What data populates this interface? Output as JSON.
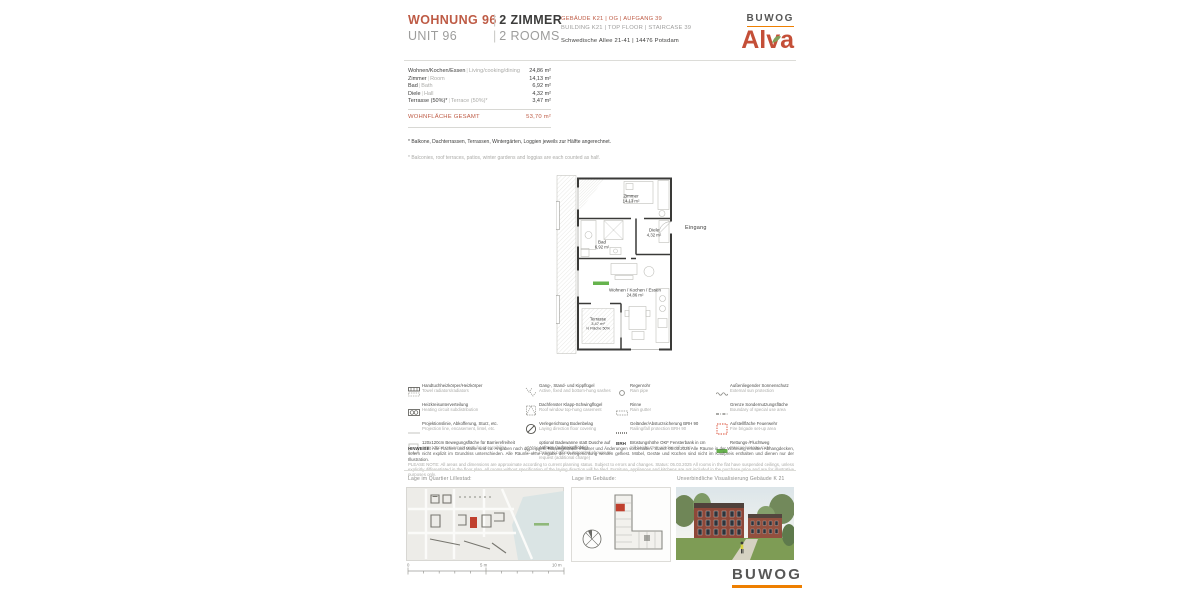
{
  "brand": {
    "buwog": "BUWOG",
    "alva": "Alva"
  },
  "header": {
    "unit_de": "WOHNUNG 96",
    "unit_en": "UNIT 96",
    "rooms_de": "2 ZIMMER",
    "rooms_en": "2 ROOMS",
    "sep": "|",
    "building_de": "GEBÄUDE K21 | OG | AUFGANG 39",
    "building_en": "BUILDING K21 | TOP FLOOR | STAIRCASE 39",
    "address": "Schwedische Allee 21-41 | 14476 Potsdam"
  },
  "area_table": {
    "sep": "|",
    "rows": [
      {
        "de": "Wohnen/Kochen/Essen",
        "en": "Living/cooking/dining",
        "value": "24,86 m²"
      },
      {
        "de": "Zimmer",
        "en": "Room",
        "value": "14,13 m²"
      },
      {
        "de": "Bad",
        "en": "Bath",
        "value": "6,92 m²"
      },
      {
        "de": "Diele",
        "en": "Hall",
        "value": "4,32 m²"
      },
      {
        "de": "Terrasse (50%)*",
        "en": "Terrace (50%)*",
        "value": "3,47 m²"
      }
    ],
    "total_label": "WOHNFLÄCHE GESAMT",
    "total_value": "53,70 m²"
  },
  "footnotes": {
    "de": "* Balkone, Dachterrassen, Terrassen, Wintergärten, Loggien jeweils zur Hälfte angerechnet.",
    "en": "* Balconies, roof terraces, patios, winter gardens and loggias are each counted as half."
  },
  "floor_plan": {
    "rooms": [
      {
        "name": "Zimmer",
        "area": "14,13 m²"
      },
      {
        "name": "Diele",
        "area": "4,32 m²"
      },
      {
        "name": "Bad",
        "area": "6,92 m²"
      },
      {
        "name": "Wohnen / Kochen / Essen",
        "area": "24,86 m²"
      },
      {
        "name": "Terrasse",
        "area": "3,47 m²",
        "note": "½ Fläche 50%"
      }
    ],
    "entrance_label": "Eingang"
  },
  "legend": {
    "items": [
      {
        "de": "Handtuchheizkörper/Heizkörper",
        "en": "Towel radiators/radiators"
      },
      {
        "de": "Heizkreisunterverteilung",
        "en": "Heating circuit subdistribution"
      },
      {
        "de": "Projektionslinie, Abkofferung, Sturz, etc.",
        "en": "Projection line, encasement, lintel, etc."
      },
      {
        "de": "120x120cm Bewegungsfläche für Barrierefreiheit",
        "en": "120x120cm movement area for accessibility"
      },
      {
        "de": "Gang-, Stand- und Kippflügel",
        "en": "Active, fixed and bottom-hung sashes"
      },
      {
        "de": "Dachfenster Klapp-Schwingflügel",
        "en": "Roof window top-hung casement"
      },
      {
        "de": "Verlegerichtung Bodenbelag",
        "en": "Laying direction floor covering"
      },
      {
        "de": "optional Badewanne statt Dusche auf Anfrage (aufpreispflichtig)",
        "en": "Optional bathtub instead of shower on request (additional charge)"
      },
      {
        "de": "Regenrohr",
        "en": "Rain pipe"
      },
      {
        "de": "Rinne",
        "en": "Rain gutter"
      },
      {
        "de": "Geländer/Absturzsicherung BRH 90",
        "en": "Railing/fall protection BRH 90"
      },
      {
        "de": "Brüstungshöhe OKF Fensterbank in cm",
        "en": "Sill height OKF window sill in cm",
        "icon_text": "BRH"
      },
      {
        "de": "Außenliegender Sonnenschutz",
        "en": "External sun protection"
      },
      {
        "de": "Grenze Sondernutzungsfläche",
        "en": "Boundary of special use area"
      },
      {
        "de": "Aufstellfläche Feuerwehr",
        "en": "Fire brigade set-up area"
      },
      {
        "de": "Rettungs-/Fluchtweg",
        "en": "Rescue/escape route"
      }
    ]
  },
  "notes": {
    "de_label": "HINWEISE:",
    "de_text": "Alle Flächen und Maße sind ca. Angaben nach derzeitigem Planungsstand. Irrtümer und Änderungen vorbehalten. Stand: 05.03.2025 Alle Räume in der Wohnung erhalten Abhangdecken, sofern nicht explizit im Grundriss unterschieden. Alle Räume ohne Angabe der Verlegerichtung werden gefliest. Möbel, Geräte und Küchen sind nicht im Kaufpreis enthalten und dienen nur der Illustration.",
    "en_label": "PLEASE NOTE:",
    "en_text": "All areas and dimensions are approximate according to current planning status. Subject to errors and changes. Status: 05.03.2025 All rooms in the flat have suspended ceilings, unless explicitly differentiated in the floor plan. All rooms without specification of the laying direction will be tiled. Furniture, appliances and kitchens are not included in the purchase price and are for illustrative purposes only."
  },
  "panels": {
    "map_label": "Lage im Quartier Lillestad:",
    "building_label": "Lage im Gebäude:",
    "visual_label": "Unverbindliche Visualisierung Gebäude K 21",
    "scale": {
      "zero": "0",
      "mid": "5 m",
      "max": "10 m"
    }
  },
  "colors": {
    "accent_terracotta": "#BE5B45",
    "alva_red": "#C44F38",
    "buwog_orange": "#EE7F00",
    "buwog_gray": "#575756",
    "text_dark": "#3C3C3B",
    "text_gray": "#9D9D9C",
    "escape_green": "#66B34D",
    "entrance_arrow_red": "#C00000",
    "fire_area_red": "#D9442B",
    "highlight_unit_red": "#C0402E"
  }
}
